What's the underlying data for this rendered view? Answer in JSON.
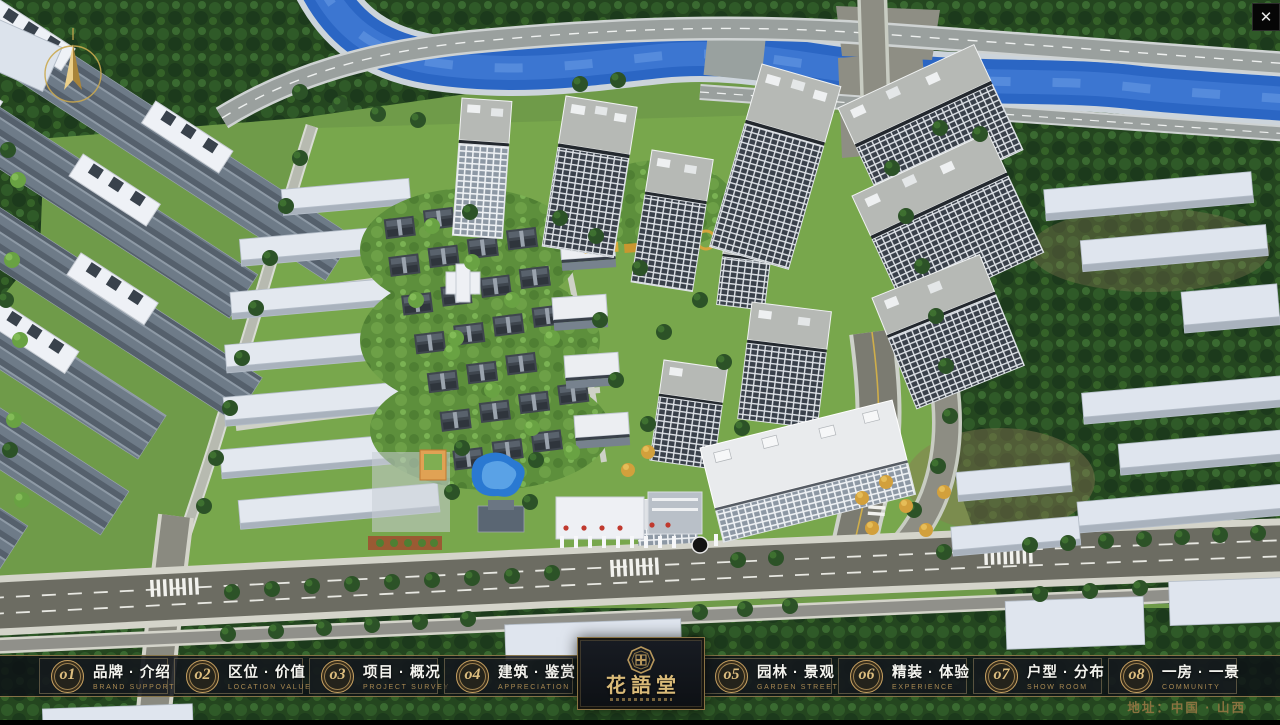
{
  "window": {
    "close_glyph": "✕"
  },
  "nav": {
    "items": [
      {
        "num": "o1",
        "title": "品牌 · 介绍",
        "subtitle": "BRAND SUPPORT"
      },
      {
        "num": "o2",
        "title": "区位 · 价值",
        "subtitle": "LOCATION VALUE"
      },
      {
        "num": "o3",
        "title": "项目 · 概况",
        "subtitle": "PROJECT SURVEY"
      },
      {
        "num": "o4",
        "title": "建筑 · 鉴赏",
        "subtitle": "APPRECIATION"
      },
      {
        "num": "o5",
        "title": "园林 · 景观",
        "subtitle": "GARDEN STREET"
      },
      {
        "num": "o6",
        "title": "精装 · 体验",
        "subtitle": "EXPERIENCE"
      },
      {
        "num": "o7",
        "title": "户型 · 分布",
        "subtitle": "SHOW ROOM"
      },
      {
        "num": "o8",
        "title": "一房 · 一景",
        "subtitle": "COMMUNITY"
      }
    ]
  },
  "logo": {
    "name": "花語堂"
  },
  "footer": {
    "address": "地址：中国 · 山西"
  },
  "colors": {
    "gold_accent": "#c7a161",
    "bar_background": "#14181d",
    "river_blue": "#2b66c4",
    "grass_green": "#6f9b49",
    "road_gray": "#8a8a80"
  }
}
